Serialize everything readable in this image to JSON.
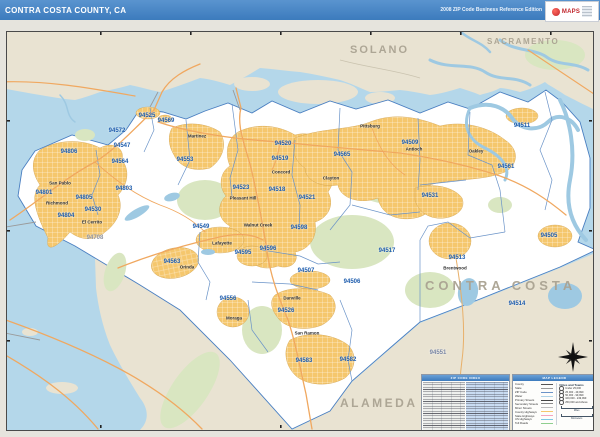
{
  "header": {
    "title": "CONTRA COSTA COUNTY, CA",
    "edition": "2008 ZIP Code Business Reference Edition",
    "logo_text": "MAPS"
  },
  "map_title_label": "CONTRA COSTA",
  "neighbor_labels": [
    {
      "label": "NAPA",
      "x": 120,
      "y": 16,
      "fs": 8,
      "ls": 1.5
    },
    {
      "label": "SOLANO",
      "x": 350,
      "y": 44,
      "fs": 11,
      "ls": 2
    },
    {
      "label": "SACRAMENTO",
      "x": 487,
      "y": 37,
      "fs": 8,
      "ls": 1.5
    },
    {
      "label": "ALAMEDA",
      "x": 340,
      "y": 396,
      "fs": 12,
      "ls": 2.5
    },
    {
      "label": "CONTRA COSTA",
      "x": 425,
      "y": 278,
      "fs": 13,
      "ls": 4
    }
  ],
  "zip_labels": [
    {
      "c": "94801",
      "x": 44,
      "y": 193
    },
    {
      "c": "94804",
      "x": 66,
      "y": 216
    },
    {
      "c": "94805",
      "x": 84,
      "y": 198
    },
    {
      "c": "94530",
      "x": 93,
      "y": 210
    },
    {
      "c": "94803",
      "x": 124,
      "y": 189
    },
    {
      "c": "94806",
      "x": 69,
      "y": 152
    },
    {
      "c": "94564",
      "x": 120,
      "y": 162
    },
    {
      "c": "94547",
      "x": 122,
      "y": 146
    },
    {
      "c": "94572",
      "x": 117,
      "y": 131
    },
    {
      "c": "94525",
      "x": 147,
      "y": 116
    },
    {
      "c": "94569",
      "x": 166,
      "y": 121
    },
    {
      "c": "94553",
      "x": 185,
      "y": 160
    },
    {
      "c": "94520",
      "x": 283,
      "y": 144
    },
    {
      "c": "94519",
      "x": 280,
      "y": 159
    },
    {
      "c": "94518",
      "x": 277,
      "y": 190
    },
    {
      "c": "94523",
      "x": 241,
      "y": 188
    },
    {
      "c": "94549",
      "x": 201,
      "y": 227
    },
    {
      "c": "94563",
      "x": 172,
      "y": 262
    },
    {
      "c": "94556",
      "x": 228,
      "y": 299
    },
    {
      "c": "94595",
      "x": 243,
      "y": 253
    },
    {
      "c": "94596",
      "x": 268,
      "y": 249
    },
    {
      "c": "94598",
      "x": 299,
      "y": 228
    },
    {
      "c": "94521",
      "x": 307,
      "y": 198
    },
    {
      "c": "94517",
      "x": 387,
      "y": 251
    },
    {
      "c": "94507",
      "x": 306,
      "y": 271
    },
    {
      "c": "94506",
      "x": 352,
      "y": 282
    },
    {
      "c": "94526",
      "x": 286,
      "y": 311
    },
    {
      "c": "94583",
      "x": 304,
      "y": 361
    },
    {
      "c": "94582",
      "x": 348,
      "y": 360
    },
    {
      "c": "94565",
      "x": 342,
      "y": 155
    },
    {
      "c": "94509",
      "x": 410,
      "y": 143
    },
    {
      "c": "94531",
      "x": 430,
      "y": 196
    },
    {
      "c": "94561",
      "x": 506,
      "y": 167
    },
    {
      "c": "94511",
      "x": 522,
      "y": 126
    },
    {
      "c": "94505",
      "x": 549,
      "y": 236
    },
    {
      "c": "94513",
      "x": 457,
      "y": 258
    },
    {
      "c": "94514",
      "x": 517,
      "y": 304
    },
    {
      "c": "94708",
      "x": 95,
      "y": 238,
      "tc": "#8f94a0"
    },
    {
      "c": "94551",
      "x": 438,
      "y": 353,
      "tc": "#7a87a5"
    }
  ],
  "city_labels": [
    {
      "label": "San Pablo",
      "x": 60,
      "y": 183
    },
    {
      "label": "Richmond",
      "x": 57,
      "y": 203
    },
    {
      "label": "El Cerrito",
      "x": 92,
      "y": 222
    },
    {
      "label": "Martinez",
      "x": 197,
      "y": 136
    },
    {
      "label": "Concord",
      "x": 281,
      "y": 172
    },
    {
      "label": "Pleasant Hill",
      "x": 243,
      "y": 198
    },
    {
      "label": "Walnut Creek",
      "x": 258,
      "y": 225
    },
    {
      "label": "Lafayette",
      "x": 222,
      "y": 243
    },
    {
      "label": "Orinda",
      "x": 187,
      "y": 267
    },
    {
      "label": "Moraga",
      "x": 234,
      "y": 318
    },
    {
      "label": "Danville",
      "x": 292,
      "y": 298
    },
    {
      "label": "San Ramon",
      "x": 307,
      "y": 333
    },
    {
      "label": "Clayton",
      "x": 331,
      "y": 178
    },
    {
      "label": "Pittsburg",
      "x": 370,
      "y": 126
    },
    {
      "label": "Antioch",
      "x": 414,
      "y": 149
    },
    {
      "label": "Oakley",
      "x": 476,
      "y": 151
    },
    {
      "label": "Brentwood",
      "x": 455,
      "y": 268
    }
  ],
  "index_panel": {
    "title": "ZIP CODE INDEX"
  },
  "legend_panel": {
    "title": "MAP LEGEND",
    "items": [
      {
        "label": "County",
        "sw": "#555555"
      },
      {
        "label": "State",
        "sw": "#999999"
      },
      {
        "label": "ZIP Code",
        "sw": "#6a93c8"
      },
      {
        "label": "Water",
        "sw": "#aed3e8"
      },
      {
        "label": "Primary Streets",
        "sw": "#444444"
      },
      {
        "label": "Secondary Streets",
        "sw": "#8a8a8a"
      },
      {
        "label": "Minor Streets",
        "sw": "#bdbdbd"
      },
      {
        "label": "County Highways",
        "sw": "#f5c76d"
      },
      {
        "label": "State Highways",
        "sw": "#f4a6c0"
      },
      {
        "label": "US Highways",
        "sw": "#7ec8e3"
      },
      {
        "label": "Toll Roads",
        "sw": "#8fcf8f"
      }
    ],
    "cities_title": "Cities and Towns",
    "city_classes": [
      {
        "label": "Under 25,000"
      },
      {
        "label": "25,000 - 49,999"
      },
      {
        "label": "50,000 - 99,999"
      },
      {
        "label": "100,000 - 249,999"
      },
      {
        "label": "250,000 and Above"
      }
    ],
    "scale_miles": "Miles",
    "scale_km": "Kilometers"
  },
  "colors": {
    "header_blue": "#3c7bbd",
    "water": "#b4d7ea",
    "outside_land": "#e9e3d2",
    "county_fill": "#ffffff",
    "urban_yellow": "#f5c76d",
    "parks_green": "#d9e6c1",
    "zip_label_blue": "#1d5cad",
    "neighbor_gray": "#aaa392",
    "highway_orange": "#f0a860",
    "zip_boundary_blue": "#6a93c8"
  }
}
